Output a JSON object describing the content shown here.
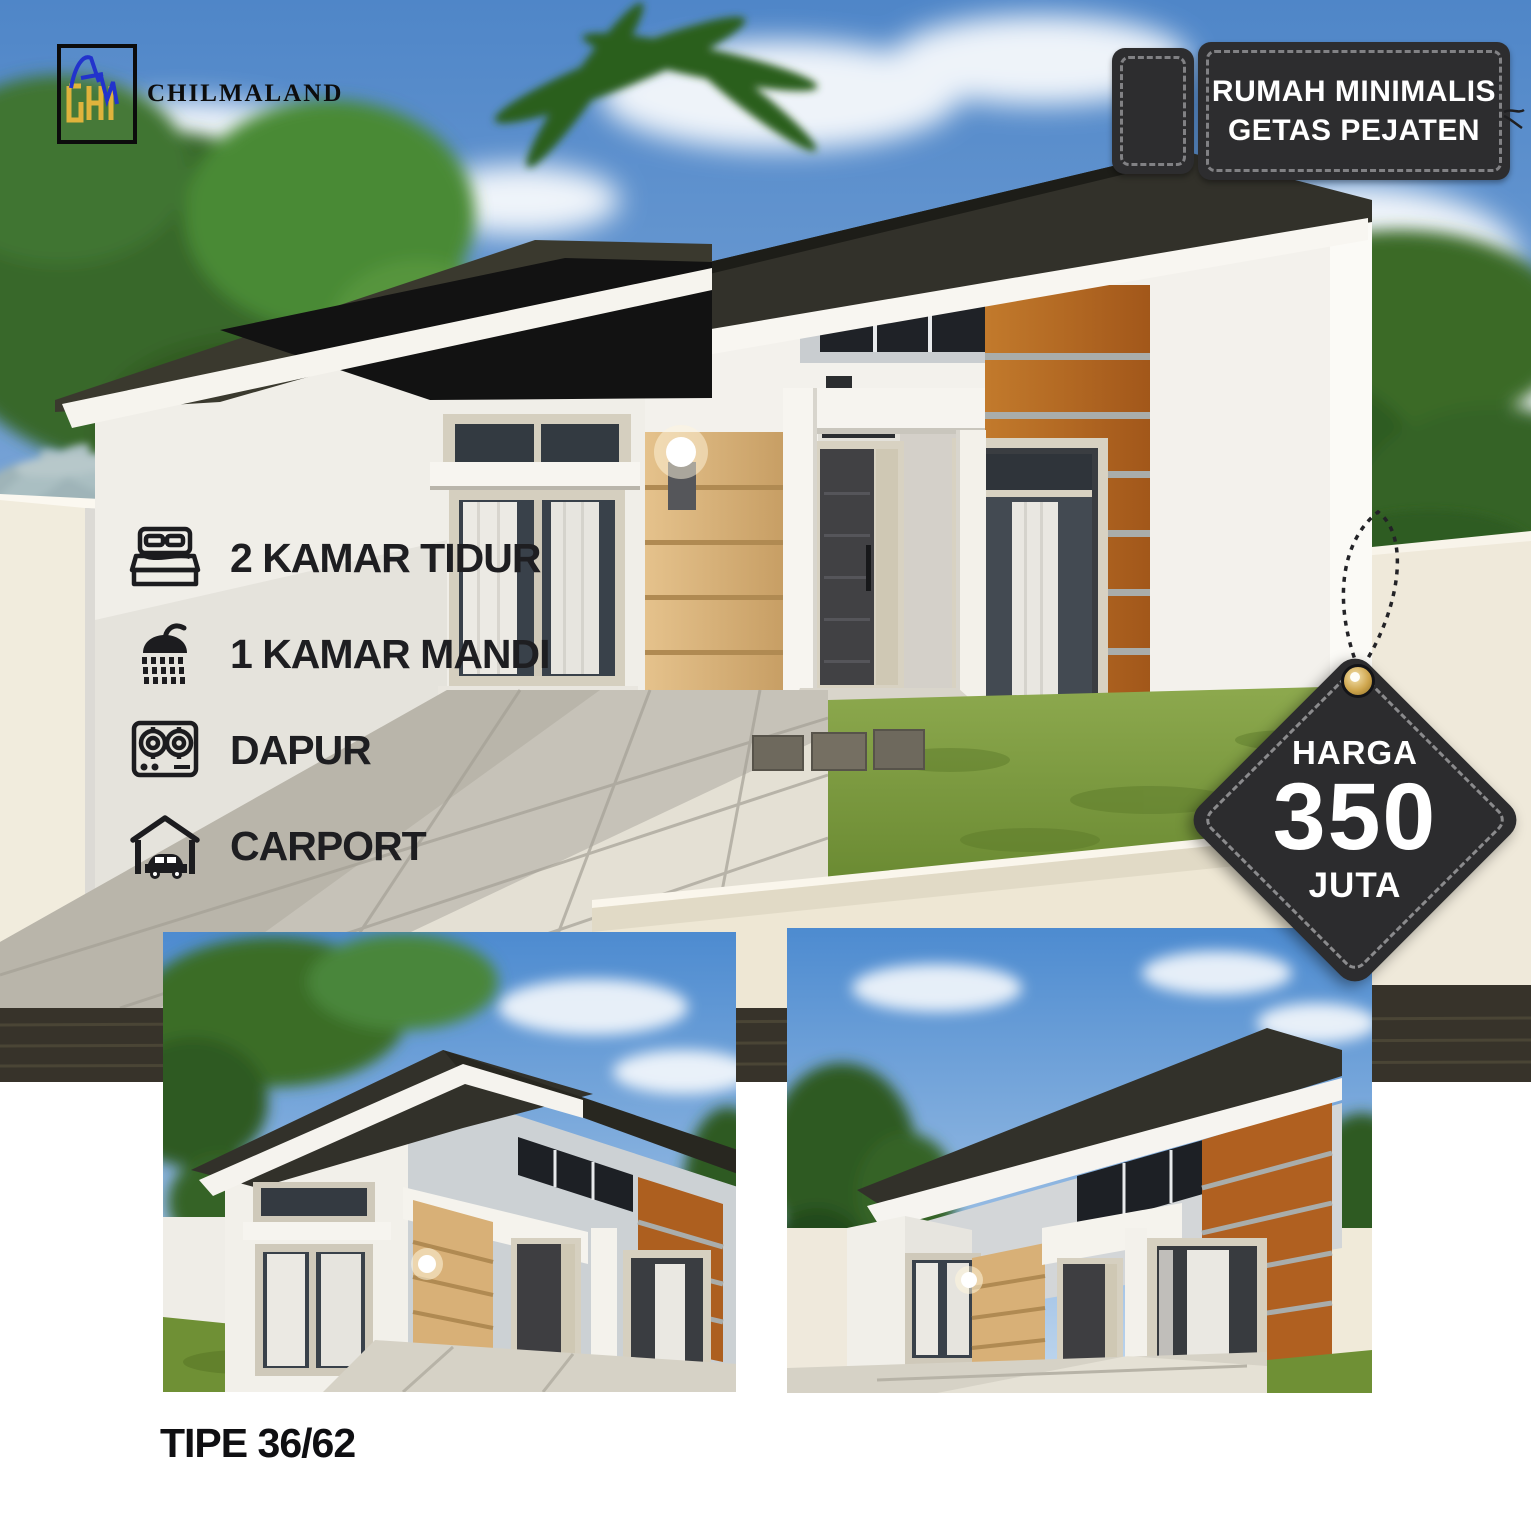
{
  "brand": {
    "name": "CHILMALAND"
  },
  "location_tag": {
    "line1": "RUMAH MINIMALIS",
    "line2": "GETAS PEJATEN"
  },
  "features": [
    {
      "icon": "bed-icon",
      "label": "2 KAMAR TIDUR"
    },
    {
      "icon": "shower-icon",
      "label": "1 KAMAR MANDI"
    },
    {
      "icon": "stove-icon",
      "label": "DAPUR"
    },
    {
      "icon": "carport-icon",
      "label": "CARPORT"
    }
  ],
  "price_tag": {
    "label": "HARGA",
    "amount": "350",
    "unit": "JUTA"
  },
  "type_label": "TIPE 36/62",
  "colors": {
    "tag_charcoal": "#2d2d2f",
    "grommet_gold": "#cfa64e",
    "text_dark": "#1e1e21",
    "wood_siding": "#d8b077",
    "wood_panel": "#b5641e",
    "grass": "#7b9a3e",
    "sky": "#5d93d2",
    "roof": "#32312a"
  }
}
